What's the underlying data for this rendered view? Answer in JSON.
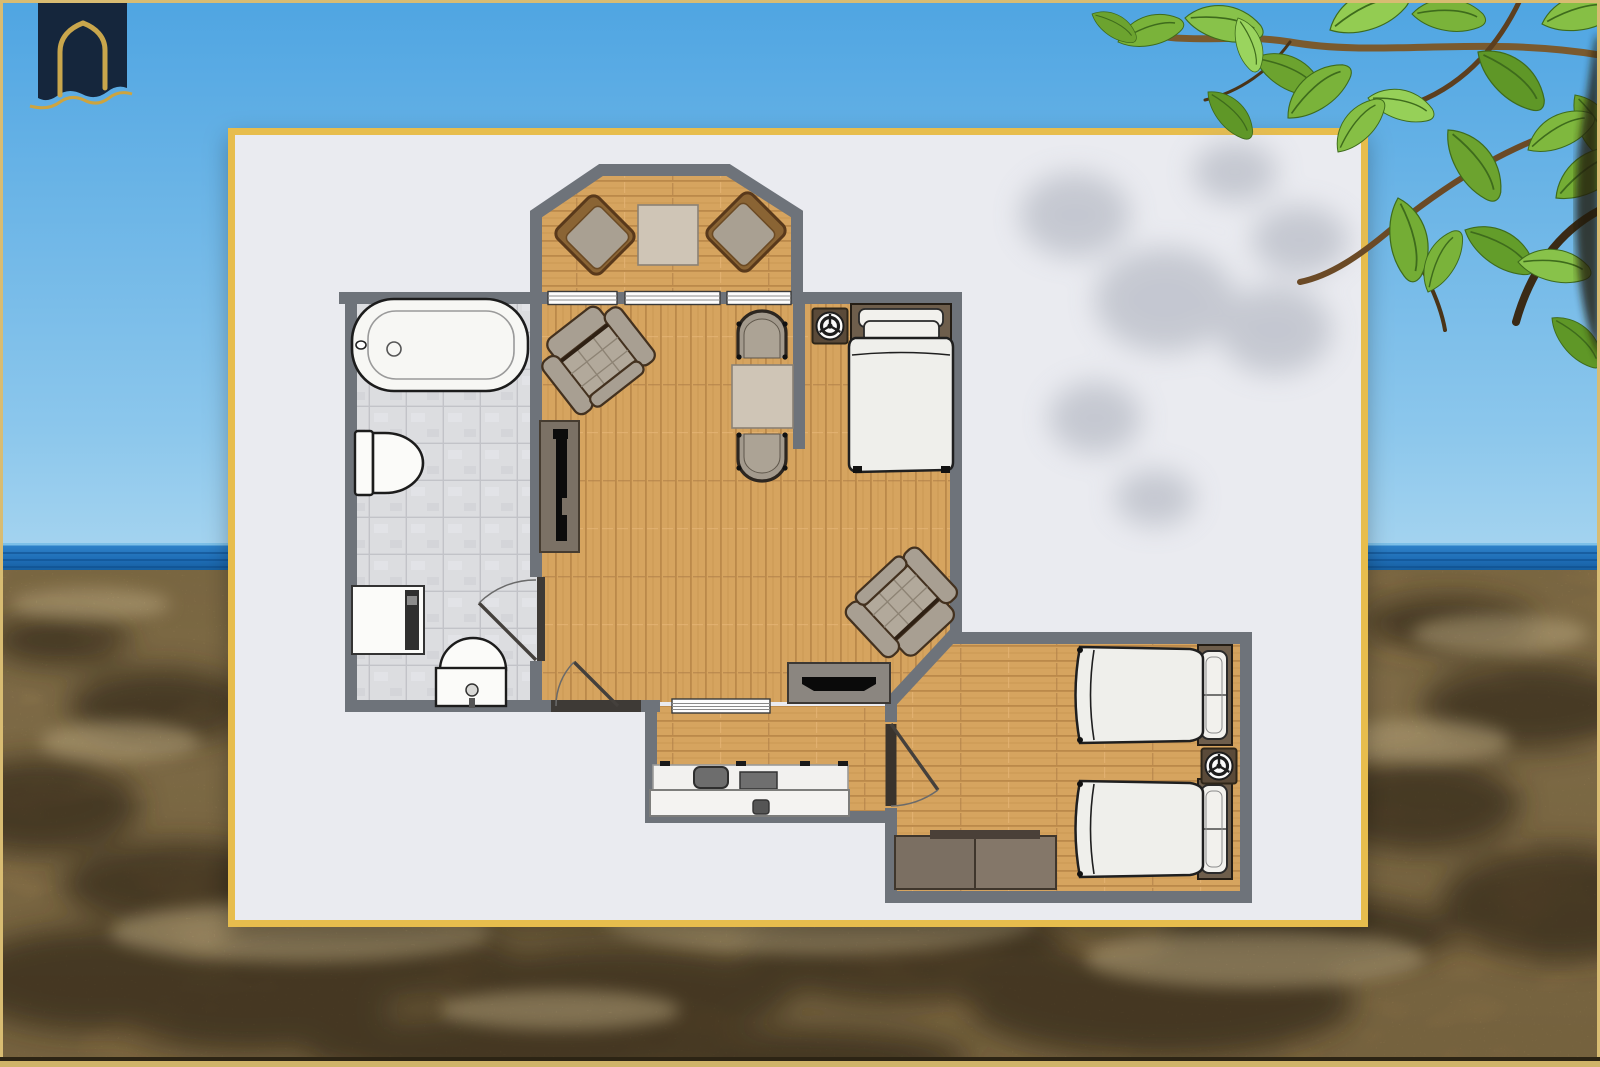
{
  "brand": {
    "logo_icon": "arched-doorway-emblem",
    "logo_bg_color": "#15263c",
    "logo_gold_color": "#c9a64c"
  },
  "frame": {
    "border_color": "#d8bc72"
  },
  "card": {
    "bg_color": "#eaebf0",
    "border_color": "#e7bd4e"
  },
  "environment": {
    "sky_top_color": "#4fa5e2",
    "sky_bottom_color": "#a9d6f0",
    "sea_color": "#1e6db6",
    "sand_color": "#c7a267",
    "leaf_colors": [
      "#6ca32f",
      "#88c24a",
      "#5f9727",
      "#96d058"
    ]
  },
  "floorplan": {
    "wall_color": "#6e737a",
    "wood_floor_color": "#d6a45f",
    "tile_floor_color": "#dcdde0",
    "window_count": 4,
    "door_count": 3,
    "rooms": [
      {
        "id": "bathroom",
        "items": [
          "bathtub",
          "toilet",
          "washer-unit",
          "pedestal-sink",
          "swing-door"
        ]
      },
      {
        "id": "terrace-bay",
        "items": [
          "deck-chair",
          "side-table",
          "deck-chair"
        ]
      },
      {
        "id": "living-dining",
        "items": [
          "armchair",
          "media-unit",
          "dining-table",
          "tub-chair",
          "tub-chair",
          "armchair",
          "tv-stand",
          "entrance-door"
        ]
      },
      {
        "id": "sleeping-nook",
        "items": [
          "double-bed",
          "ceiling-fan"
        ]
      },
      {
        "id": "kitchen",
        "items": [
          "counter-sink-cooktop",
          "island-counter",
          "pass-through-window"
        ]
      },
      {
        "id": "twin-bedroom",
        "items": [
          "twin-bed",
          "twin-bed",
          "ceiling-fan",
          "dresser",
          "swing-door"
        ]
      }
    ]
  }
}
